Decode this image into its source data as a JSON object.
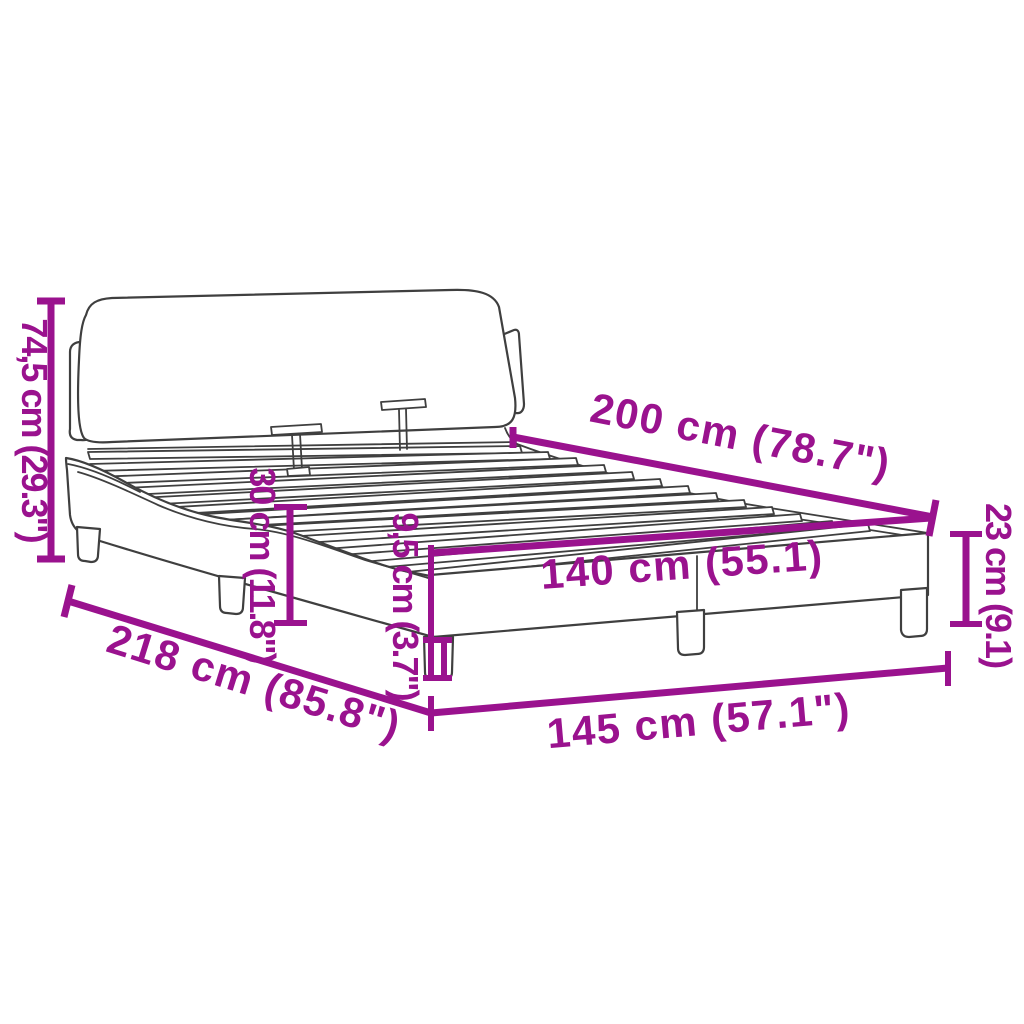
{
  "diagram": {
    "subject": "bed-frame-with-headboard-dimension-diagram",
    "background_color": "#ffffff",
    "accent_color": "#9a128e",
    "outline_color": "#3f3f3f",
    "measurements": {
      "headboard_height": "74,5 cm (29.3\")",
      "inner_length": "200 cm (78.7\")",
      "rail_height": "30 cm (11.8\")",
      "base_rail_height": "9,5 cm (3.7\")",
      "inner_width": "140 cm (55.1)",
      "base_height": "23 cm (9.1)",
      "outer_length": "218 cm (85.8\")",
      "outer_width": "145 cm (57.1\")"
    }
  }
}
